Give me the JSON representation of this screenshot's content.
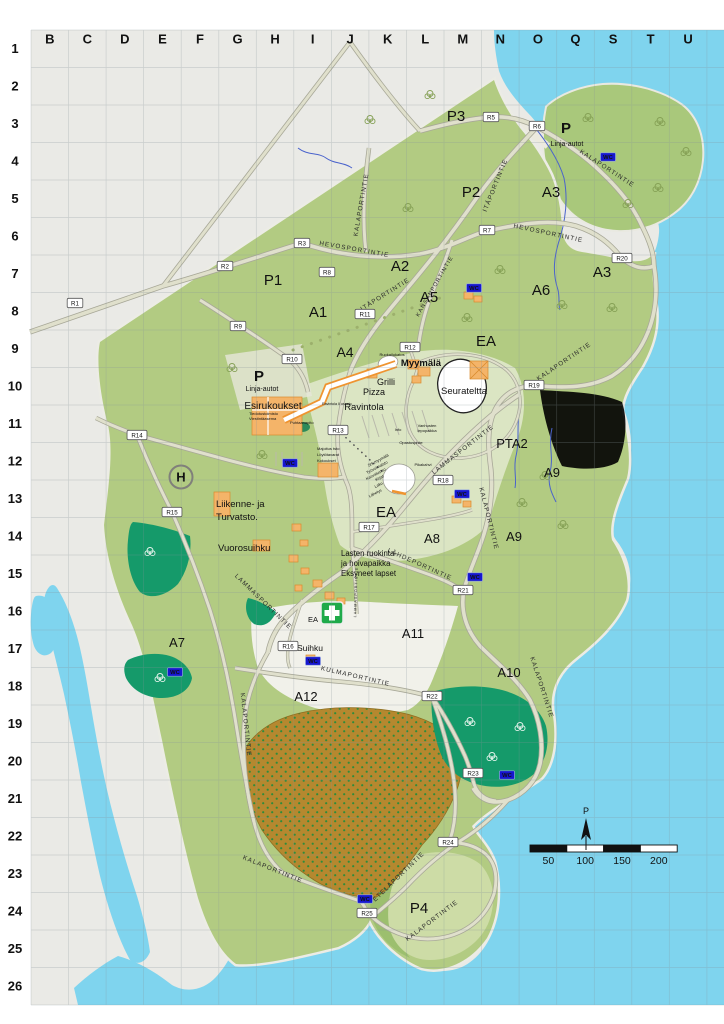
{
  "map": {
    "description": "Summer event campground map with coordinate grid",
    "colors": {
      "water": "#7fd4ee",
      "land_green": "#b2cb82",
      "island_green": "#a9c87b",
      "forest_green": "#159a6a",
      "orchard_brown": "#b5882f",
      "building_orange": "#f4b469",
      "wc_blue": "#1616cf",
      "accent_label_orange": "#9a6200",
      "first_aid_green": "#1faa4a"
    },
    "grid": {
      "columns": [
        "B",
        "C",
        "D",
        "E",
        "F",
        "G",
        "H",
        "I",
        "J",
        "K",
        "L",
        "M",
        "N",
        "O",
        "Q",
        "S",
        "T",
        "U"
      ],
      "rows": [
        "1",
        "2",
        "3",
        "4",
        "5",
        "6",
        "7",
        "8",
        "9",
        "10",
        "11",
        "12",
        "13",
        "14",
        "15",
        "16",
        "17",
        "18",
        "19",
        "20",
        "21",
        "22",
        "23",
        "24",
        "25",
        "26"
      ]
    },
    "area_labels": [
      {
        "t": "P3",
        "x": 456,
        "y": 121
      },
      {
        "t": "P2",
        "x": 471,
        "y": 197
      },
      {
        "t": "P1",
        "x": 273,
        "y": 285
      },
      {
        "t": "A3",
        "x": 551,
        "y": 197
      },
      {
        "t": "A3",
        "x": 602,
        "y": 277
      },
      {
        "t": "A2",
        "x": 400,
        "y": 271
      },
      {
        "t": "A1",
        "x": 318,
        "y": 317
      },
      {
        "t": "A5",
        "x": 429,
        "y": 302
      },
      {
        "t": "A6",
        "x": 541,
        "y": 295
      },
      {
        "t": "A4",
        "x": 345,
        "y": 357,
        "fs": 14
      },
      {
        "t": "EA",
        "x": 486,
        "y": 346
      },
      {
        "t": "EA",
        "x": 386,
        "y": 517
      },
      {
        "t": "PTA2",
        "x": 512,
        "y": 448,
        "fs": 13
      },
      {
        "t": "A9",
        "x": 552,
        "y": 477,
        "fs": 13
      },
      {
        "t": "A9",
        "x": 514,
        "y": 541,
        "fs": 13
      },
      {
        "t": "A8",
        "x": 432,
        "y": 543,
        "fs": 13
      },
      {
        "t": "A11",
        "x": 413,
        "y": 638,
        "fs": 13
      },
      {
        "t": "A7",
        "x": 177,
        "y": 647,
        "fs": 13
      },
      {
        "t": "A12",
        "x": 306,
        "y": 701,
        "fs": 13
      },
      {
        "t": "A10",
        "x": 509,
        "y": 677,
        "fs": 13
      },
      {
        "t": "P4",
        "x": 419,
        "y": 913
      },
      {
        "t": "P",
        "x": 259,
        "y": 381,
        "b": 1
      },
      {
        "t": "P",
        "x": 566,
        "y": 133,
        "b": 1
      }
    ],
    "road_labels": [
      {
        "t": "HEVOSPORTINTIE",
        "x": 354,
        "y": 251,
        "r": 10
      },
      {
        "t": "HEVOSPORTINTIE",
        "x": 548,
        "y": 235,
        "r": 12
      },
      {
        "t": "ITÄPORTINTIE",
        "x": 497,
        "y": 186,
        "r": -68
      },
      {
        "t": "ITÄPORTINTIE",
        "x": 386,
        "y": 296,
        "r": -32
      },
      {
        "t": "KALAPORTINTIE",
        "x": 606,
        "y": 170,
        "r": 33
      },
      {
        "t": "KALAPORTINTIE",
        "x": 363,
        "y": 205,
        "r": -80
      },
      {
        "t": "KANSANPORTINTIE",
        "x": 436,
        "y": 287,
        "r": -60,
        "fs": 5.6
      },
      {
        "t": "KALAPORTINTIE",
        "x": 565,
        "y": 363,
        "r": -34
      },
      {
        "t": "LAMMASPORTINTIE",
        "x": 464,
        "y": 451,
        "r": -38
      },
      {
        "t": "LAMMASPORTINTIE",
        "x": 262,
        "y": 603,
        "r": 44
      },
      {
        "t": "LAMMASPORTINTIE",
        "x": 357,
        "y": 592,
        "r": -88,
        "fs": 3.6
      },
      {
        "t": "KALAPORTINTIE",
        "x": 487,
        "y": 519,
        "r": 76
      },
      {
        "t": "LÄHDEPORTINTIE",
        "x": 419,
        "y": 566,
        "r": 24
      },
      {
        "t": "KULMAPORTINTIE",
        "x": 355,
        "y": 678,
        "r": 13
      },
      {
        "t": "KALAPORTINTIE",
        "x": 540,
        "y": 688,
        "r": 72
      },
      {
        "t": "KALAPORTINTIE",
        "x": 244,
        "y": 725,
        "r": 84
      },
      {
        "t": "KALAPORTINTIE",
        "x": 272,
        "y": 871,
        "r": 22
      },
      {
        "t": "ETELÄPORTINTIE",
        "x": 400,
        "y": 878,
        "r": -44
      },
      {
        "t": "KALAPORTINTIE",
        "x": 433,
        "y": 922,
        "r": -37
      }
    ],
    "facility_labels": [
      {
        "t": "Linja-autot",
        "x": 567,
        "y": 146,
        "fs": 7
      },
      {
        "t": "Linja-autot",
        "x": 262,
        "y": 391,
        "fs": 7
      },
      {
        "t": "Myymälä",
        "x": 421,
        "y": 366,
        "fs": 9.5,
        "b": 1
      },
      {
        "t": "Grilli",
        "x": 386,
        "y": 385
      },
      {
        "t": "Pizza",
        "x": 374,
        "y": 395
      },
      {
        "t": "Ravintola",
        "x": 364,
        "y": 410,
        "fs": 9.5
      },
      {
        "t": "Esirukoukset",
        "x": 273,
        "y": 409,
        "fs": 10
      },
      {
        "t": "Seurateltta",
        "x": 464,
        "y": 394,
        "fs": 9.5
      },
      {
        "t": "Liikenne- ja",
        "x": 216,
        "y": 507,
        "fs": 9.5,
        "c": "#9a6200",
        "a": "start"
      },
      {
        "t": "Turvatsto.",
        "x": 216,
        "y": 520,
        "fs": 9.5,
        "c": "#9a6200",
        "a": "start"
      },
      {
        "t": "Vuorosuihku",
        "x": 218,
        "y": 551,
        "fs": 9.5,
        "c": "#9a6200",
        "a": "start"
      },
      {
        "t": "Suihku",
        "x": 310,
        "y": 651,
        "fs": 8.5
      },
      {
        "t": "EA",
        "x": 313,
        "y": 622,
        "fs": 7.5,
        "c": "#c46a00"
      },
      {
        "t": "Lasten ruokinta-",
        "x": 341,
        "y": 556,
        "fs": 7.8,
        "a": "start"
      },
      {
        "t": "ja hoivapaikka",
        "x": 341,
        "y": 566,
        "fs": 7.8,
        "a": "start"
      },
      {
        "t": "Eksyneet lapset",
        "x": 341,
        "y": 576,
        "fs": 7.8,
        "a": "start"
      }
    ],
    "tiny_labels": [
      {
        "t": "Ruokailukatos",
        "x": 392,
        "y": 356
      },
      {
        "t": "Tiedotustoimisto",
        "x": 249,
        "y": 415,
        "a": "start"
      },
      {
        "t": "Viestintäasema",
        "x": 249,
        "y": 420,
        "a": "start"
      },
      {
        "t": "Ravintola II osasto",
        "x": 322,
        "y": 405,
        "a": "start",
        "fs": 3.6
      },
      {
        "t": "Puhtaanapito",
        "x": 290,
        "y": 424,
        "a": "start"
      },
      {
        "t": "Majoitus tsto",
        "x": 317,
        "y": 450,
        "a": "start"
      },
      {
        "t": "Löytötavarat",
        "x": 317,
        "y": 456,
        "a": "start"
      },
      {
        "t": "Kokoukset",
        "x": 317,
        "y": 462,
        "a": "start"
      },
      {
        "t": "Info",
        "x": 398,
        "y": 431
      },
      {
        "t": "Vanhusten",
        "x": 427,
        "y": 427
      },
      {
        "t": "lepopaikka",
        "x": 427,
        "y": 432
      },
      {
        "t": "Opastuspiste",
        "x": 411,
        "y": 444
      },
      {
        "t": "Pikakahvi",
        "x": 423,
        "y": 466
      },
      {
        "t": "Srk myymälä",
        "x": 389,
        "y": 456,
        "r": -28,
        "a": "end"
      },
      {
        "t": "Työvoimatsto",
        "x": 388,
        "y": 463,
        "r": -28,
        "a": "end"
      },
      {
        "t": "Kasvatustso",
        "x": 386,
        "y": 470,
        "r": -28,
        "a": "end"
      },
      {
        "t": "Kirjat",
        "x": 384,
        "y": 477,
        "r": -28,
        "a": "end"
      },
      {
        "t": "Laku",
        "x": 383,
        "y": 484,
        "r": -28,
        "a": "end"
      },
      {
        "t": "Lähetys",
        "x": 382,
        "y": 491,
        "r": -28,
        "a": "end"
      }
    ],
    "r_markers": [
      {
        "t": "R1",
        "x": 75,
        "y": 303
      },
      {
        "t": "R2",
        "x": 225,
        "y": 266
      },
      {
        "t": "R3",
        "x": 302,
        "y": 243
      },
      {
        "t": "R5",
        "x": 491,
        "y": 117
      },
      {
        "t": "R6",
        "x": 537,
        "y": 126
      },
      {
        "t": "R7",
        "x": 487,
        "y": 230
      },
      {
        "t": "R8",
        "x": 327,
        "y": 272
      },
      {
        "t": "R9",
        "x": 238,
        "y": 326
      },
      {
        "t": "R10",
        "x": 292,
        "y": 359
      },
      {
        "t": "R11",
        "x": 365,
        "y": 314
      },
      {
        "t": "R12",
        "x": 410,
        "y": 347
      },
      {
        "t": "R13",
        "x": 338,
        "y": 430
      },
      {
        "t": "R14",
        "x": 137,
        "y": 435
      },
      {
        "t": "R15",
        "x": 172,
        "y": 512
      },
      {
        "t": "R16",
        "x": 288,
        "y": 646
      },
      {
        "t": "R17",
        "x": 369,
        "y": 527
      },
      {
        "t": "R18",
        "x": 443,
        "y": 480
      },
      {
        "t": "R19",
        "x": 534,
        "y": 385
      },
      {
        "t": "R20",
        "x": 622,
        "y": 258
      },
      {
        "t": "R21",
        "x": 463,
        "y": 590
      },
      {
        "t": "R22",
        "x": 432,
        "y": 696
      },
      {
        "t": "R23",
        "x": 473,
        "y": 773
      },
      {
        "t": "R24",
        "x": 448,
        "y": 842
      },
      {
        "t": "R25",
        "x": 367,
        "y": 913
      }
    ],
    "wc": {
      "label": "WC",
      "positions": [
        [
          608,
          157
        ],
        [
          474,
          288
        ],
        [
          290,
          463
        ],
        [
          462,
          494
        ],
        [
          475,
          577
        ],
        [
          175,
          672
        ],
        [
          313,
          661
        ],
        [
          507,
          775
        ],
        [
          365,
          899
        ]
      ]
    },
    "scale_bar": {
      "x": 530,
      "y": 845,
      "seg_w": 36.8,
      "h": 7,
      "tick_labels": [
        "50",
        "100",
        "150",
        "200"
      ]
    },
    "north_arrow": {
      "label": "P",
      "x": 586,
      "y": 814
    },
    "helipad": {
      "label": "H",
      "x": 181,
      "y": 477
    },
    "first_aid": {
      "x": 332,
      "y": 613
    }
  }
}
